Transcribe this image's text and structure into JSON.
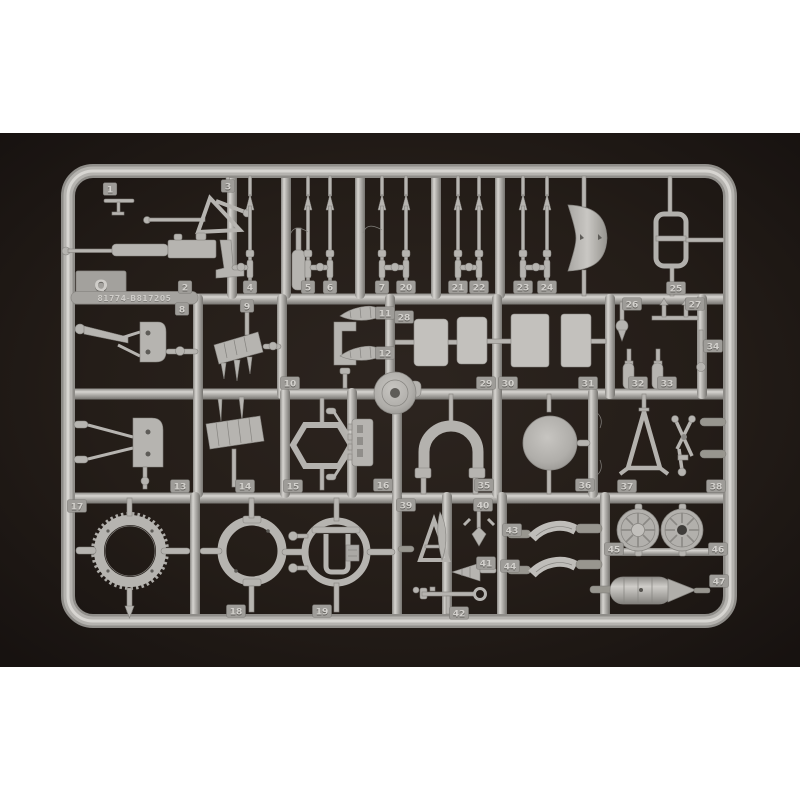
{
  "image": {
    "description": "Photograph of a light-gray injection-molded model kit sprue (runner Q) holding aircraft model parts numbered 1 to 47, shot on a dark brown background, letterboxed on a white product page",
    "page_background_color": "#ffffff",
    "photo_background_color": "#241d18",
    "plastic_color": "#b6b4b0"
  },
  "sprue": {
    "letter": "Q",
    "mold_code": "81774-B817205",
    "part_count": 47,
    "tags": [
      {
        "label": "1",
        "x": 110,
        "y": 189
      },
      {
        "label": "2",
        "x": 185,
        "y": 287
      },
      {
        "label": "3",
        "x": 228,
        "y": 186
      },
      {
        "label": "4",
        "x": 250,
        "y": 287
      },
      {
        "label": "5",
        "x": 308,
        "y": 287
      },
      {
        "label": "6",
        "x": 330,
        "y": 287
      },
      {
        "label": "7",
        "x": 382,
        "y": 287
      },
      {
        "label": "8",
        "x": 182,
        "y": 309
      },
      {
        "label": "9",
        "x": 247,
        "y": 306
      },
      {
        "label": "10",
        "x": 290,
        "y": 383
      },
      {
        "label": "11",
        "x": 385,
        "y": 313
      },
      {
        "label": "12",
        "x": 385,
        "y": 353
      },
      {
        "label": "13",
        "x": 180,
        "y": 486
      },
      {
        "label": "14",
        "x": 245,
        "y": 486
      },
      {
        "label": "15",
        "x": 293,
        "y": 486
      },
      {
        "label": "16",
        "x": 383,
        "y": 485
      },
      {
        "label": "17",
        "x": 77,
        "y": 506
      },
      {
        "label": "18",
        "x": 236,
        "y": 611
      },
      {
        "label": "19",
        "x": 322,
        "y": 611
      },
      {
        "label": "20",
        "x": 406,
        "y": 287
      },
      {
        "label": "21",
        "x": 458,
        "y": 287
      },
      {
        "label": "22",
        "x": 479,
        "y": 287
      },
      {
        "label": "23",
        "x": 523,
        "y": 287
      },
      {
        "label": "24",
        "x": 547,
        "y": 287
      },
      {
        "label": "25",
        "x": 676,
        "y": 288
      },
      {
        "label": "26",
        "x": 632,
        "y": 304
      },
      {
        "label": "27",
        "x": 695,
        "y": 304
      },
      {
        "label": "28",
        "x": 404,
        "y": 317
      },
      {
        "label": "29",
        "x": 486,
        "y": 383
      },
      {
        "label": "30",
        "x": 508,
        "y": 383
      },
      {
        "label": "31",
        "x": 588,
        "y": 383
      },
      {
        "label": "32",
        "x": 638,
        "y": 383
      },
      {
        "label": "33",
        "x": 667,
        "y": 383
      },
      {
        "label": "34",
        "x": 713,
        "y": 346
      },
      {
        "label": "35",
        "x": 484,
        "y": 485
      },
      {
        "label": "36",
        "x": 585,
        "y": 485
      },
      {
        "label": "37",
        "x": 627,
        "y": 486
      },
      {
        "label": "38",
        "x": 716,
        "y": 486
      },
      {
        "label": "39",
        "x": 406,
        "y": 505
      },
      {
        "label": "40",
        "x": 483,
        "y": 505
      },
      {
        "label": "41",
        "x": 486,
        "y": 563
      },
      {
        "label": "42",
        "x": 459,
        "y": 613
      },
      {
        "label": "43",
        "x": 512,
        "y": 530
      },
      {
        "label": "44",
        "x": 510,
        "y": 566
      },
      {
        "label": "45",
        "x": 614,
        "y": 549
      },
      {
        "label": "46",
        "x": 718,
        "y": 549
      },
      {
        "label": "47",
        "x": 719,
        "y": 581
      }
    ]
  }
}
